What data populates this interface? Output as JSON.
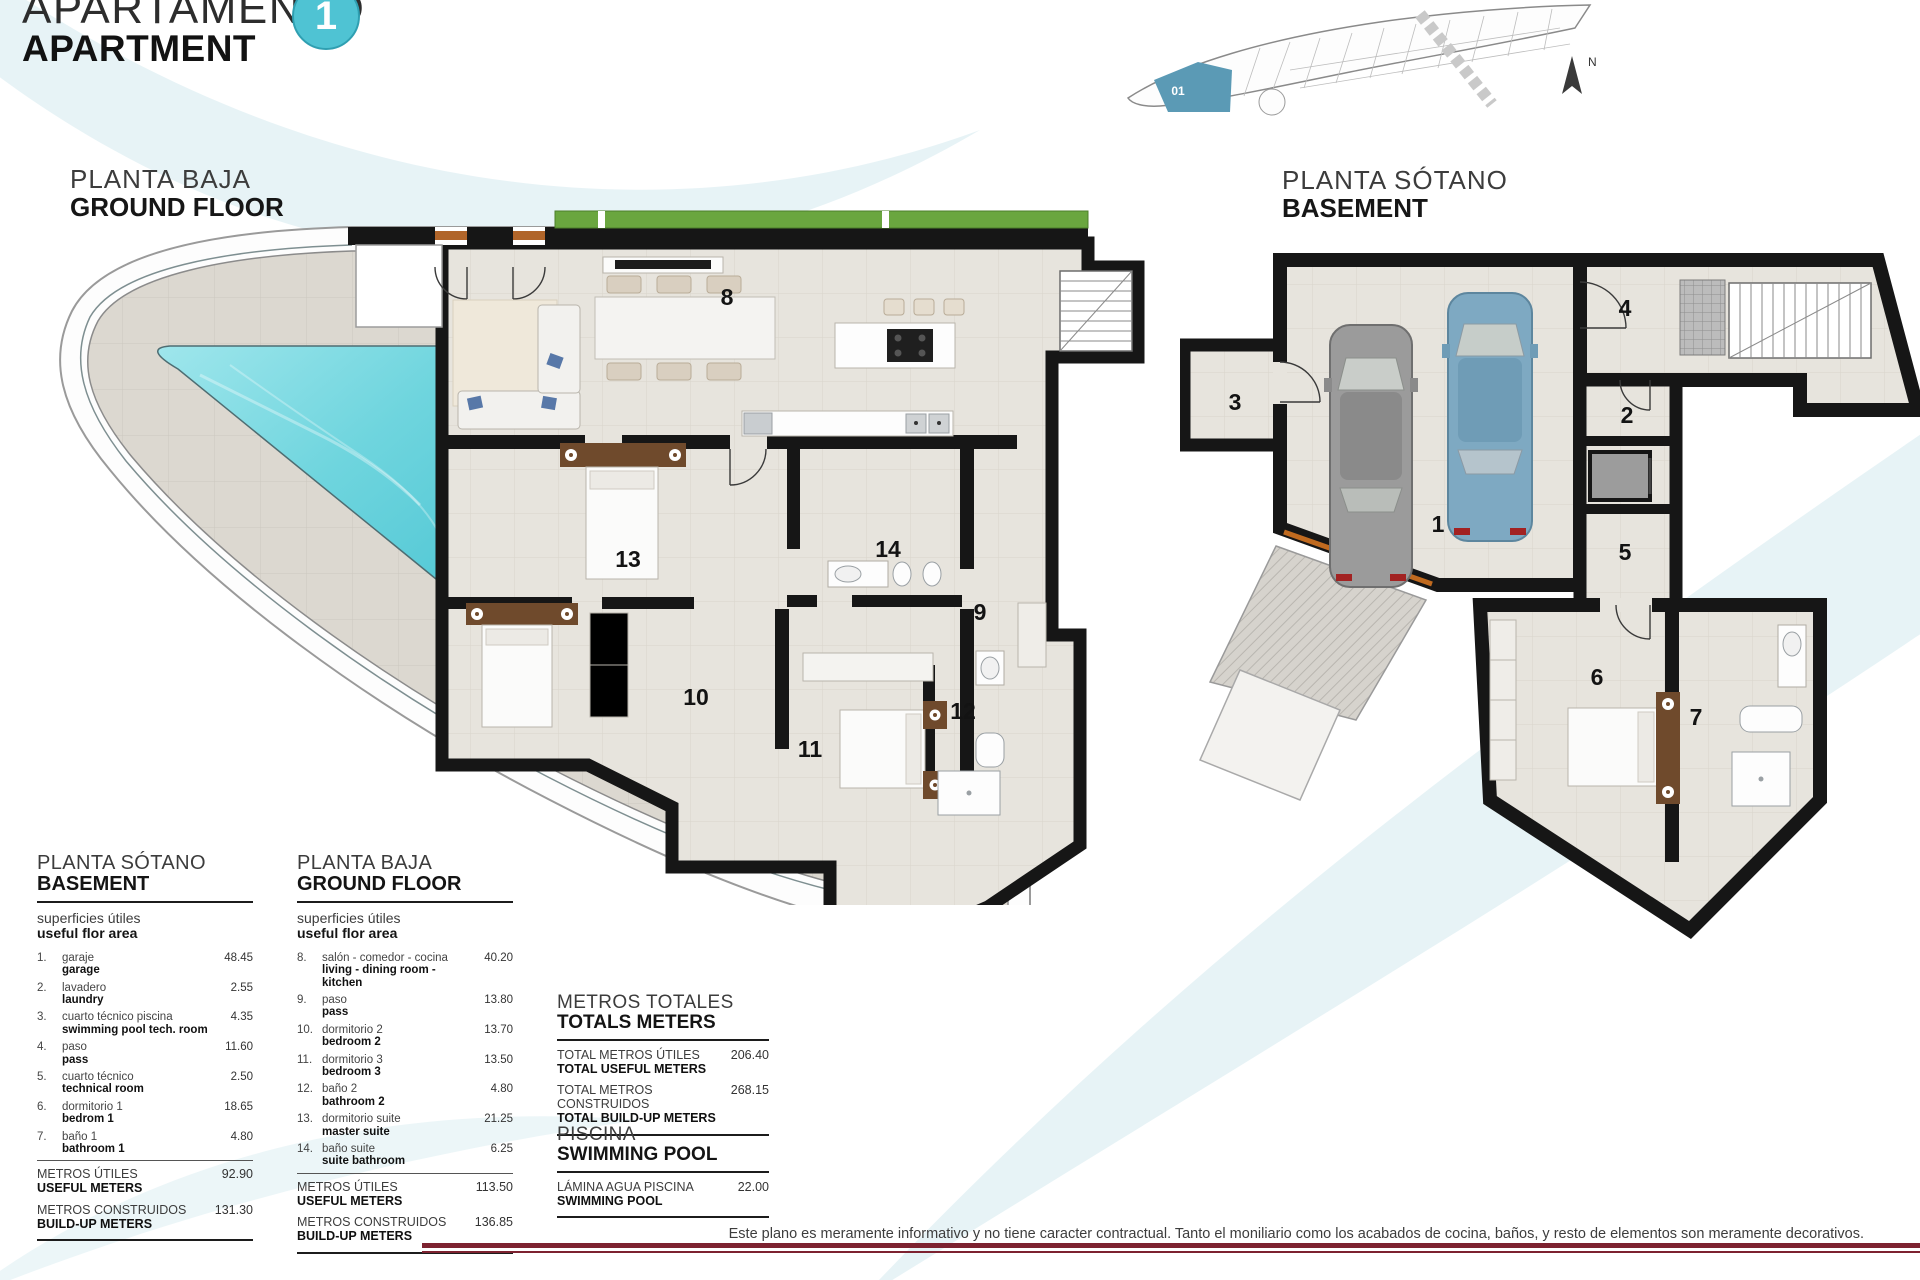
{
  "header": {
    "title_es": "APARTAMENTO",
    "title_en": "APARTMENT",
    "unit_number": "1"
  },
  "colors": {
    "accent": "#4fc3d3",
    "footer_rule": "#7d2230",
    "highlighted_unit": "#5b9ab5",
    "pool_water": "#7adce4"
  },
  "key_plan": {
    "unit_label": "01",
    "north_label": "N"
  },
  "plans": {
    "ground": {
      "title_es": "PLANTA BAJA",
      "title_en": "GROUND FLOOR",
      "room_numbers": [
        "8",
        "9",
        "10",
        "11",
        "12",
        "13",
        "14"
      ]
    },
    "basement": {
      "title_es": "PLANTA SÓTANO",
      "title_en": "BASEMENT",
      "room_numbers": [
        "1",
        "2",
        "3",
        "4",
        "5",
        "6",
        "7"
      ]
    }
  },
  "legend_basement": {
    "title_es": "PLANTA SÓTANO",
    "title_en": "BASEMENT",
    "subtitle_es": "superficies útiles",
    "subtitle_en": "useful flor area",
    "items": [
      {
        "num": "1.",
        "es": "garaje",
        "en": "garage",
        "value": "48.45"
      },
      {
        "num": "2.",
        "es": "lavadero",
        "en": "laundry",
        "value": "2.55"
      },
      {
        "num": "3.",
        "es": "cuarto técnico piscina",
        "en": "swimming pool tech. room",
        "value": "4.35"
      },
      {
        "num": "4.",
        "es": "paso",
        "en": "pass",
        "value": "11.60"
      },
      {
        "num": "5.",
        "es": "cuarto técnico",
        "en": "technical room",
        "value": "2.50"
      },
      {
        "num": "6.",
        "es": "dormitorio 1",
        "en": "bedrom 1",
        "value": "18.65"
      },
      {
        "num": "7.",
        "es": "baño 1",
        "en": "bathroom 1",
        "value": "4.80"
      }
    ],
    "totals": [
      {
        "es": "METROS ÚTILES",
        "en": "USEFUL METERS",
        "value": "92.90"
      },
      {
        "es": "METROS CONSTRUIDOS",
        "en": "BUILD-UP METERS",
        "value": "131.30"
      }
    ]
  },
  "legend_ground": {
    "title_es": "PLANTA BAJA",
    "title_en": "GROUND FLOOR",
    "subtitle_es": "superficies útiles",
    "subtitle_en": "useful flor area",
    "items": [
      {
        "num": "8.",
        "es": "salón - comedor - cocina",
        "en": "living - dining room - kitchen",
        "value": "40.20"
      },
      {
        "num": "9.",
        "es": "paso",
        "en": "pass",
        "value": "13.80"
      },
      {
        "num": "10.",
        "es": "dormitorio 2",
        "en": "bedroom 2",
        "value": "13.70"
      },
      {
        "num": "11.",
        "es": "dormitorio 3",
        "en": "bedroom 3",
        "value": "13.50"
      },
      {
        "num": "12.",
        "es": "baño 2",
        "en": "bathroom 2",
        "value": "4.80"
      },
      {
        "num": "13.",
        "es": "dormitorio suite",
        "en": "master suite",
        "value": "21.25"
      },
      {
        "num": "14.",
        "es": "baño suite",
        "en": "suite bathroom",
        "value": "6.25"
      }
    ],
    "totals": [
      {
        "es": "METROS ÚTILES",
        "en": "USEFUL METERS",
        "value": "113.50"
      },
      {
        "es": "METROS CONSTRUIDOS",
        "en": "BUILD-UP METERS",
        "value": "136.85"
      }
    ]
  },
  "totals_section": {
    "title_es": "METROS TOTALES",
    "title_en": "TOTALS METERS",
    "rows": [
      {
        "es": "TOTAL METROS ÚTILES",
        "en": "TOTAL USEFUL METERS",
        "value": "206.40"
      },
      {
        "es": "TOTAL METROS CONSTRUIDOS",
        "en": "TOTAL BUILD-UP METERS",
        "value": "268.15"
      }
    ]
  },
  "pool_section": {
    "title_es": "PISCINA",
    "title_en": "SWIMMING POOL",
    "rows": [
      {
        "es": "LÁMINA AGUA PISCINA",
        "en": "SWIMMING POOL",
        "value": "22.00"
      }
    ]
  },
  "footer": {
    "disclaimer": "Este plano es meramente informativo y no tiene caracter contractual. Tanto el moniliario como los acabados de cocina, baños, y resto de elementos son meramente decorativos."
  }
}
